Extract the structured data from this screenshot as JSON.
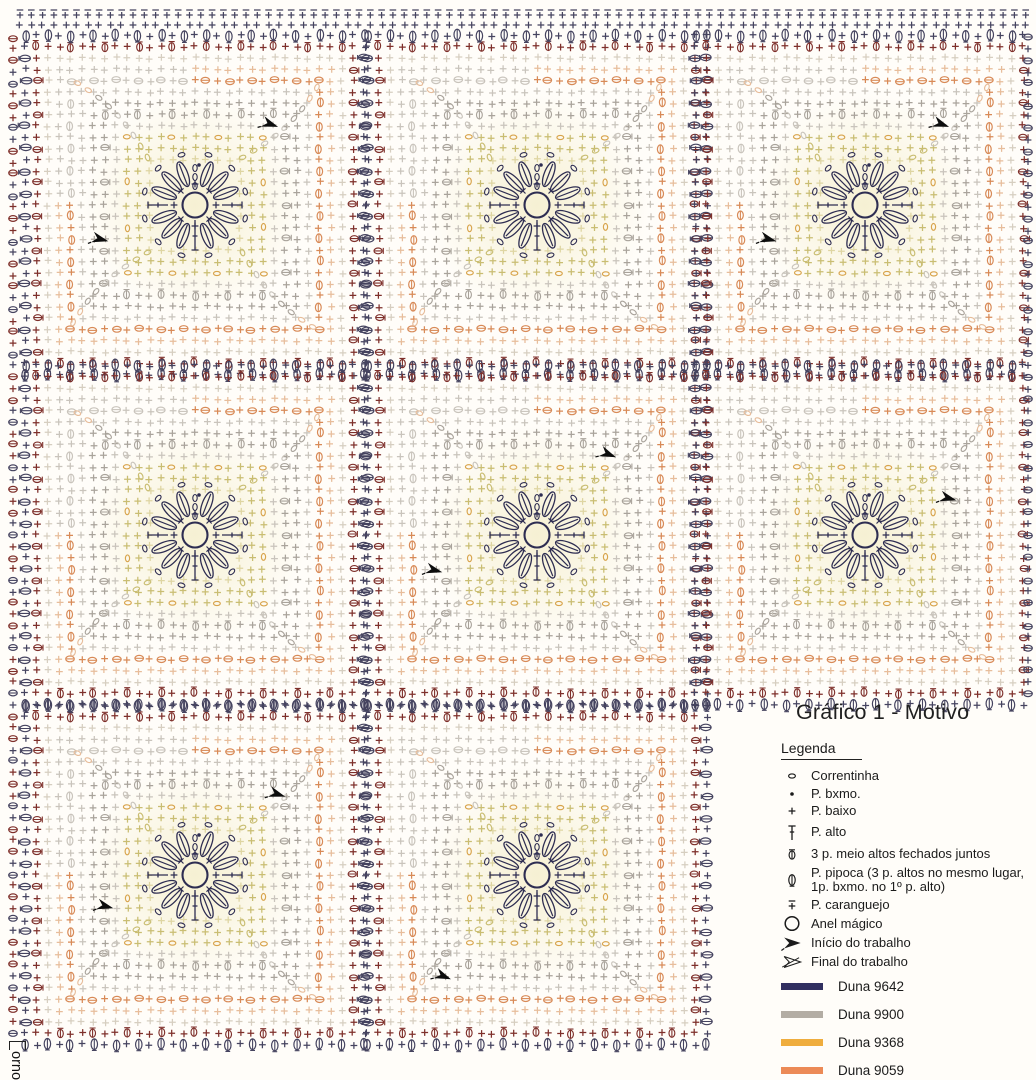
{
  "title": "Gráfico 1 - Motivo",
  "side_label": "orno",
  "legend": {
    "heading": "Legenda",
    "items": [
      {
        "symbol": "chain",
        "label": "Correntinha"
      },
      {
        "symbol": "slip",
        "label": "P. bxmo."
      },
      {
        "symbol": "single",
        "label": "P. baixo"
      },
      {
        "symbol": "double",
        "label": "P. alto"
      },
      {
        "symbol": "cluster",
        "label": "3 p. meio altos fechados juntos"
      },
      {
        "symbol": "popcorn",
        "label": "P. pipoca (3 p. altos no mesmo lugar, 1p. bxmo. no 1º p. alto)"
      },
      {
        "symbol": "crab",
        "label": "P. caranguejo"
      },
      {
        "symbol": "magic-ring",
        "label": "Anel mágico"
      },
      {
        "symbol": "start-arrow",
        "label": "Início do trabalho"
      },
      {
        "symbol": "end-arrow",
        "label": "Final do trabalho"
      }
    ],
    "colors": [
      {
        "name": "Duna 9642",
        "hex": "#312f60"
      },
      {
        "name": "Duna 9900",
        "hex": "#b3ada4"
      },
      {
        "name": "Duna 9368",
        "hex": "#efad3e"
      },
      {
        "name": "Duna 9059",
        "hex": "#ec8a56"
      },
      {
        "name": "Duna 9245",
        "hex": "#8a2320"
      }
    ]
  },
  "chart": {
    "cell": 11.3,
    "flower_color": "#2e2d52",
    "columns": [
      195,
      537,
      865
    ],
    "rows": [
      205,
      535,
      875
    ],
    "missing_square": [
      2,
      2
    ],
    "palette": {
      "navy": "#45435f",
      "red": "#7e2f2a",
      "orange": "#d88a57",
      "peach": "#e7bd9b",
      "amber": "#d8a44c",
      "yellow": "#c9bd72",
      "paleyellow": "#ded5a2",
      "gray": "#a9a39b",
      "palegray": "#c9c4bc",
      "cream": "#d6cec0",
      "black": "#1c1c1c"
    },
    "rings": [
      {
        "r": 4,
        "glyph": "plus",
        "color": "paleyellow"
      },
      {
        "r": 5,
        "glyph": "plus",
        "color": "yellow"
      },
      {
        "r": 6,
        "glyph": "plus",
        "color": "yellow",
        "alt": "chain",
        "altColor": "amber",
        "altEvery": 4
      },
      {
        "r": 7,
        "glyph": "plus",
        "color": "palegray"
      },
      {
        "r": 8,
        "glyph": "plus",
        "color": "gray",
        "alt": "cluster",
        "altEvery": 3
      },
      {
        "r": 9,
        "glyph": "plus",
        "color": "gray"
      },
      {
        "r": 10,
        "glyph": "plus",
        "color": "palegray"
      },
      {
        "r": 11,
        "glyph": "plus",
        "color": "orange",
        "alt": "oval",
        "altEvery": 2,
        "warmSplit": true,
        "coolColor": "palegray"
      },
      {
        "r": 12,
        "glyph": "plus",
        "color": "peach",
        "warmSplit": true,
        "coolColor": "palegray"
      },
      {
        "r": 13,
        "glyph": "plus",
        "color": "cream"
      },
      {
        "r": 14,
        "glyph": "plus",
        "color": "red",
        "alt": "cluster",
        "altEvery": 3
      },
      {
        "r": 15,
        "glyph": "plus",
        "color": "navy",
        "alt": "popcorn",
        "altEvery": 2
      }
    ],
    "arrows": [
      {
        "x": 270,
        "y": 124,
        "a": 20
      },
      {
        "x": 941,
        "y": 124,
        "a": 20
      },
      {
        "x": 100,
        "y": 239,
        "a": 15
      },
      {
        "x": 768,
        "y": 239,
        "a": 15
      },
      {
        "x": 608,
        "y": 454,
        "a": 22
      },
      {
        "x": 434,
        "y": 570,
        "a": 15
      },
      {
        "x": 948,
        "y": 498,
        "a": 15
      },
      {
        "x": 277,
        "y": 794,
        "a": 18
      },
      {
        "x": 105,
        "y": 906,
        "a": 15
      },
      {
        "x": 443,
        "y": 976,
        "a": 22
      }
    ]
  }
}
